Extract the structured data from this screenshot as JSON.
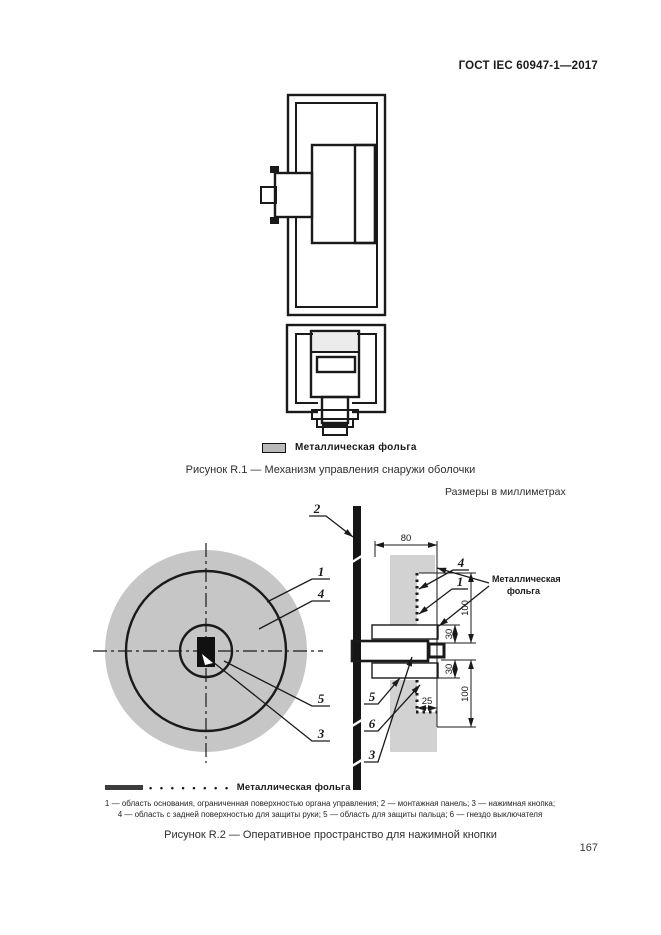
{
  "header": {
    "title": "ГОСТ IEC 60947-1—2017"
  },
  "figure_r1": {
    "caption": "Рисунок R.1 — Механизм управления снаружи оболочки",
    "legend": {
      "label": "Металлическая фольга"
    }
  },
  "figure_r2": {
    "units_note": "Размеры в миллиметрах",
    "caption": "Рисунок R.2 — Оперативное пространство для нажимной кнопки",
    "foil_callout": {
      "line1": "Металлическая",
      "line2": "фольга"
    },
    "legend": {
      "dots": "• • • • • • • •",
      "label": "Металлическая фольга"
    },
    "part_labels": {
      "circle_1": "1",
      "circle_4": "4",
      "circle_5": "5",
      "circle_3": "3",
      "panel_2": "2",
      "section_4": "4",
      "section_1": "1",
      "section_5": "5",
      "section_6": "6",
      "section_3": "3"
    },
    "dimensions": {
      "width_80": "80",
      "upper_100": "100",
      "upper_30": "30",
      "lower_30": "30",
      "lower_100": "100",
      "step_25": "25"
    },
    "footnotes": {
      "line1": "1 — область основания, ограниченная поверхностью органа управления; 2 — монтажная панель; 3 — нажимная кнопка;",
      "line2": "4 — область с задней поверхностью для защиты руки; 5 — область для защиты пальца; 6 — гнездо выключателя"
    }
  },
  "page": {
    "number": "167"
  },
  "colors": {
    "ink": "#1a1a1a",
    "wall_gray": "#b9b9b9",
    "foil_ring_gray": "#c6c6c6",
    "zone_gray": "#d2d2d2",
    "cap_gray": "#8a8a8a"
  }
}
